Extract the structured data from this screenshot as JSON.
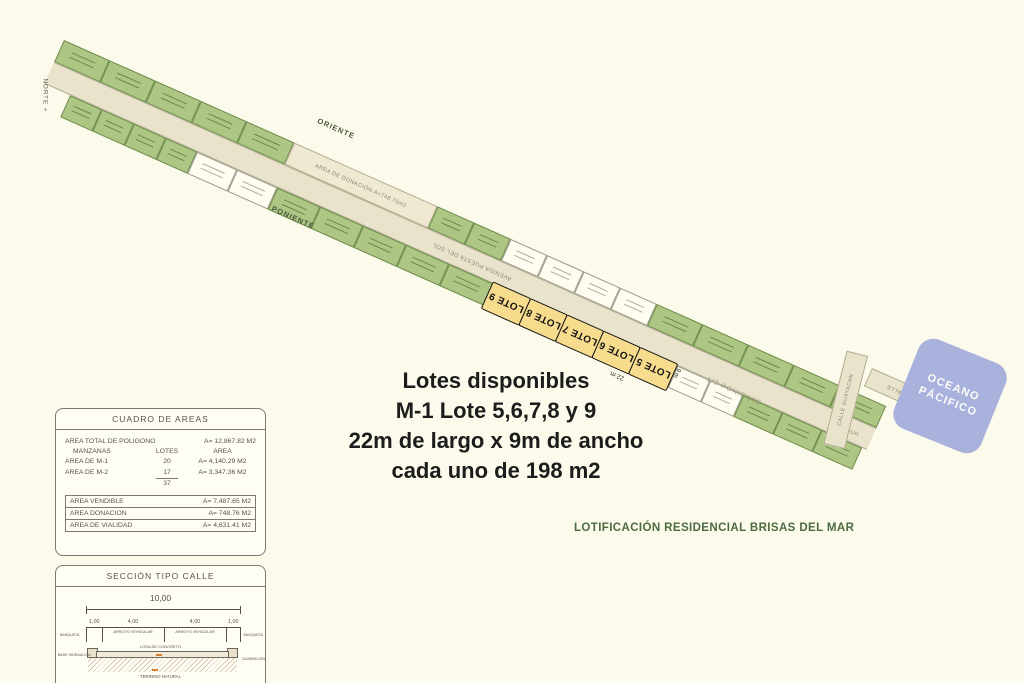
{
  "colors": {
    "bg": "#fcfaea",
    "lot_green": "#aec684",
    "lot_white": "#fffdf1",
    "road": "#e8e3ca",
    "donation": "#efe9d2",
    "highlight": "#f7dc8d",
    "ocean": "#a9b2dd",
    "accent_green": "#4c6b41",
    "ink": "#58524a"
  },
  "map": {
    "north_label": "NORTE +",
    "oriente_label": "ORIENTE",
    "poniente_label": "PONIENTE",
    "road_label": "AVENIDA PUESTA DEL SOL",
    "donation_label": "AREA DE DONACIÓN A=748.76m2",
    "half_poniente_label": "1/2 PONIENTE",
    "sur_label": "SUR",
    "calle_guayacan_label": "CALLE GUAYACAN",
    "calle_label": "CALLE",
    "dim_length": "22 m",
    "dim_width": "9 m",
    "upper_row": [
      {
        "t": "g",
        "w": 50
      },
      {
        "t": "g",
        "w": 50
      },
      {
        "t": "g",
        "w": 50
      },
      {
        "t": "g",
        "w": 50
      },
      {
        "t": "g",
        "w": 52
      },
      {
        "t": "d",
        "w": 157
      },
      {
        "t": "g",
        "w": 40
      },
      {
        "t": "g",
        "w": 40
      },
      {
        "t": "w",
        "w": 40
      },
      {
        "t": "w",
        "w": 40
      },
      {
        "t": "w",
        "w": 40
      },
      {
        "t": "w",
        "w": 40
      },
      {
        "t": "g",
        "w": 50
      },
      {
        "t": "g",
        "w": 50
      },
      {
        "t": "g",
        "w": 50
      },
      {
        "t": "g",
        "w": 50
      },
      {
        "t": "g",
        "w": 51
      }
    ],
    "lower_row": [
      {
        "t": "s",
        "w": 28
      },
      {
        "t": "g",
        "w": 35
      },
      {
        "t": "g",
        "w": 35
      },
      {
        "t": "g",
        "w": 35
      },
      {
        "t": "g",
        "w": 34
      },
      {
        "t": "w",
        "w": 44
      },
      {
        "t": "w",
        "w": 44
      },
      {
        "t": "g",
        "w": 47
      },
      {
        "t": "g",
        "w": 47
      },
      {
        "t": "g",
        "w": 47
      },
      {
        "t": "g",
        "w": 47
      },
      {
        "t": "g",
        "w": 48
      },
      {
        "t": "y",
        "w": 42,
        "label": "LOTE 9"
      },
      {
        "t": "y",
        "w": 41,
        "label": "LOTE 8"
      },
      {
        "t": "y",
        "w": 41,
        "label": "LOTE 7"
      },
      {
        "t": "y",
        "w": 41,
        "label": "LOTE 6"
      },
      {
        "t": "y",
        "w": 42,
        "label": "LOTE 5"
      },
      {
        "t": "w",
        "w": 36
      },
      {
        "t": "w",
        "w": 36
      },
      {
        "t": "g",
        "w": 43
      },
      {
        "t": "g",
        "w": 43
      },
      {
        "t": "g",
        "w": 44
      }
    ]
  },
  "ocean": {
    "line1": "OCEANO",
    "line2": "PÁCIFICO"
  },
  "promo": {
    "lines": [
      "Lotes disponibles",
      "M-1 Lote 5,6,7,8 y 9",
      "22m de largo x 9m de ancho",
      "cada uno de 198 m2"
    ]
  },
  "project_title": "LOTIFICACIÓN RESIDENCIAL BRISAS DEL MAR",
  "areas_table": {
    "title": "CUADRO DE AREAS",
    "total_label": "AREA  TOTAL DE POLIGONO",
    "total_value": "A= 12,867.82 M2",
    "headers": [
      "MANZANAS",
      "LOTES",
      "AREA"
    ],
    "rows": [
      {
        "label": "AREA DE M-1",
        "lotes": "20",
        "area": "A= 4,140.29 M2"
      },
      {
        "label": "AREA DE M-2",
        "lotes": "17",
        "area": "A= 3,347.36 M2"
      }
    ],
    "lots_total": "37",
    "summary": [
      {
        "label": "AREA VENDIBLE",
        "value": "A= 7,487.65 M2"
      },
      {
        "label": "AREA DONACION",
        "value": "A=  748.76 M2"
      },
      {
        "label": "AREA DE VIALIDAD",
        "value": "A= 4,631.41 M2"
      }
    ]
  },
  "street_section": {
    "title": "SECCIÓN TIPO CALLE",
    "total_dim": "10,00",
    "dims": [
      "1,00",
      "4,00",
      "4,00",
      "1,00"
    ],
    "banqueta": "BANQUETA",
    "arroyo": "ARROYO VEHICULAR",
    "losa": "LOSA DE CONCRETO",
    "base": "BASE HIDRAULICA",
    "guarnicion": "GUARNICION",
    "terreno": "TERRENO NATURAL"
  }
}
